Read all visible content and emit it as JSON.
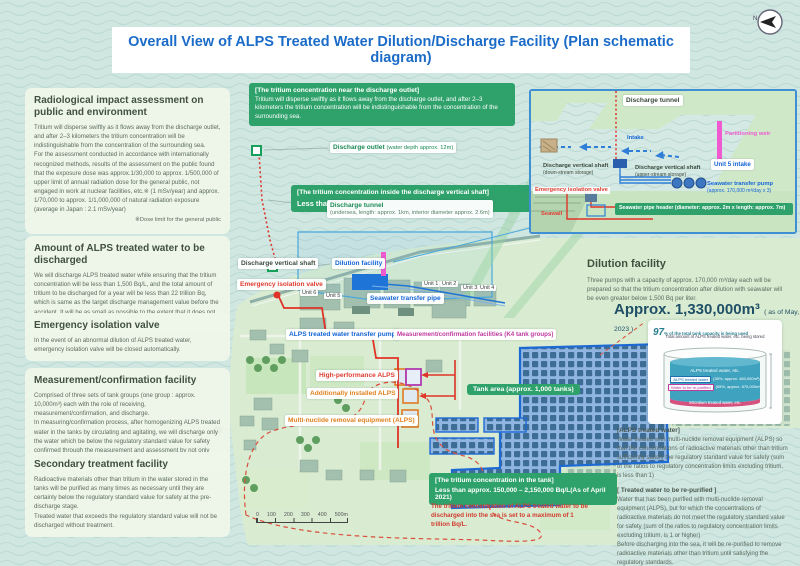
{
  "title": "Overall View of ALPS Treated Water Dilution/Discharge Facility (Plan schematic diagram)",
  "compass": {
    "n": "N"
  },
  "left_panels": [
    {
      "heading": "Radiological impact assessment on public and environment",
      "body": "Tritium will disperse swiftly as it flows away from the discharge outlet, and after 2–3 kilometers the tritium concentration will be indistinguishable from the concentration of the surrounding sea.\nFor the assessment conducted in accordance with internationally recognized methods, results of the assessment on the public found that the exposure dose was approx.1/30,000 to approx. 1/500,000 of upper limit of annual radiation dose for the general public, not engaged in work at nuclear facilities, etc.※ (1 mSv/year) and approx. 1/70,000 to approx. 1/1,000,000 of natural radiation exposure (average in Japan : 2.1 mSv/year)",
      "note": "※Dose limit for the general public"
    },
    {
      "heading": "Amount of ALPS treated water to be discharged",
      "body": "We will discharge ALPS treated water while ensuring that the tritium concentration will be less than 1,500 Bq/L, and the total amount of tritium to be discharged for a year will be less than 22 trillion Bq, which is same as the target discharge management value before the accident. It will be as small as possible to the extent that it does not interfere with decommissioning."
    },
    {
      "heading": "Emergency isolation valve",
      "body": "In the event of an abnormal dilution of ALPS treated water, emergency isolation valve will be closed automatically."
    },
    {
      "heading": "Measurement/confirmation facility",
      "body": "Comprised of three sets of tank groups (one group : approx. 10,000m³) each with the role of receiving, measurement/confirmation, and discharge.\nIn measuring/confirmation process, after homogenizing ALPS treated water in the tanks by circulating and agitating, we will discharge only the water which be below the regulatory standard value for safety confirmed through the measurement and assessment by not only TEPCO but also the external agencies"
    },
    {
      "heading": "Secondary treatment facility",
      "body": "Radioactive materials other than tritium in the water stored in the tanks will be purified as many times as necessary until they are certainly below the regulatory standard value for safety at the pre-discharge stage.\nTreated water that exceeds the regulatory standard value will not be discharged without treatment."
    }
  ],
  "callouts": {
    "near_outlet": {
      "header": "[The tritium concentration near the discharge outlet]",
      "body": "Tritium will disperse swiftly as it flows away from the discharge outlet, and after 2–3 kilometers the tritium concentration will be indistinguishable from the concentration of the surrounding sea."
    },
    "inside_shaft": {
      "header": "[The tritium concentration inside the discharge vertical shaft]",
      "value": "Less than 1,500 Bq/L"
    },
    "in_tank": {
      "header": "[The tritium concentration in the tank]",
      "value": "Less than approx. 150,000 – 2,150,000 Bq/L(As of April 2021)"
    },
    "tank_red_note": "The tritium concentration of ALPS treated water to be discharged into the sea is set to a maximum of 1 trillion Bq/L."
  },
  "map_labels": {
    "discharge_outlet": {
      "name": "Discharge outlet",
      "detail": "(water depth approx. 12m)"
    },
    "discharge_tunnel": {
      "name": "Discharge tunnel",
      "detail": "(undersea, length: approx. 1km, interior diameter approx. 2.6m)"
    },
    "discharge_vertical_shaft": "Discharge vertical shaft",
    "dilution_facility": "Dilution facility",
    "emergency_isolation_valve": "Emergency isolation valve",
    "seawater_transfer_pipe": "Seawater transfer pipe",
    "alps_transfer_pump": "ALPS treated water transfer pump",
    "measurement_confirmation": "Measurement/confirmation facilities (K4 tank groups)",
    "high_performance_alps": "High-performance ALPS",
    "additionally_installed_alps": "Additionally installed ALPS",
    "multi_nuclide_removal": "Multi-nuclide removal equipment (ALPS)",
    "tank_area": "Tank area (approx. 1,000 tanks)",
    "units": [
      "Unit 1",
      "Unit 2",
      "Unit 3",
      "Unit 4",
      "Unit 5",
      "Unit 6"
    ]
  },
  "inset": {
    "discharge_tunnel": "Discharge tunnel",
    "intake": "Intake",
    "partitioning_weir": "Partitioning weir",
    "unit5_intake": "Unit 5 intake",
    "shaft_down": {
      "name": "Discharge vertical shaft",
      "detail": "(down-stream storage)"
    },
    "shaft_up": {
      "name": "Discharge vertical shaft",
      "detail": "(upper-stream storage)"
    },
    "emergency_isolation_valve": "Emergency isolation valve",
    "seawater_pump": {
      "name": "Seawater transfer pump",
      "detail": "(approx. 170,000 m³/day x 3)"
    },
    "pipe_header": "Seawater pipe header (diameter: approx. 2m x length: approx. 7m)",
    "seawall": "Seawall"
  },
  "right_panel": {
    "dilution": {
      "heading": "Dilution facility",
      "body": "Three pumps with a capacity of approx. 170,000 m³/day each will be prepared so that the tritium concentration after dilution with seawater will be even greater below 1,500 Bq per liter."
    },
    "storage": {
      "amount": "Approx. 1,330,000m³",
      "date": "( as of May, 2023 )"
    },
    "tank_graphic": {
      "pct": "97",
      "pct_note": "% of the total tank capacity is being used",
      "sub": "Total amount of ALPS treated water, etc. being stored",
      "inner_title": "ALPS treated water, etc.",
      "row1_label": "ALPS treated water",
      "row1_value": "(35%, approx. 460,000m³)",
      "row2_label": "Water to be re-purified",
      "row2_value": "(65%, approx. 870,000m³)",
      "band": "Strontium treated water, etc."
    },
    "definitions": [
      {
        "header": "[ALPS treated water]",
        "body": "Water treated with multi-nuclide removal equipment (ALPS) so that the concentrations of radioactive materials other than tritium sufficiently satisfy the regulatory standard value for safety (sum of the ratios to regulatory concentration limits excluding tritium, is less than 1)"
      },
      {
        "header": "[ Treated water to be re-purified ]",
        "body": "Water that has been purified with multi-nuclide removal equipment (ALPS), but for which the concentrations of radioactive materials do not meet the regulatory standard value for safety (sum of the ratios to regulatory concentration limits excluding tritium, is 1 or higher)\nBefore discharging into the sea, it will be re-purified to remove radioactive materials other than tritium until satisfying the regulatory standards."
      }
    ]
  },
  "scalebar": {
    "ticks": [
      "0",
      "100",
      "200",
      "300",
      "400",
      "500m"
    ]
  }
}
